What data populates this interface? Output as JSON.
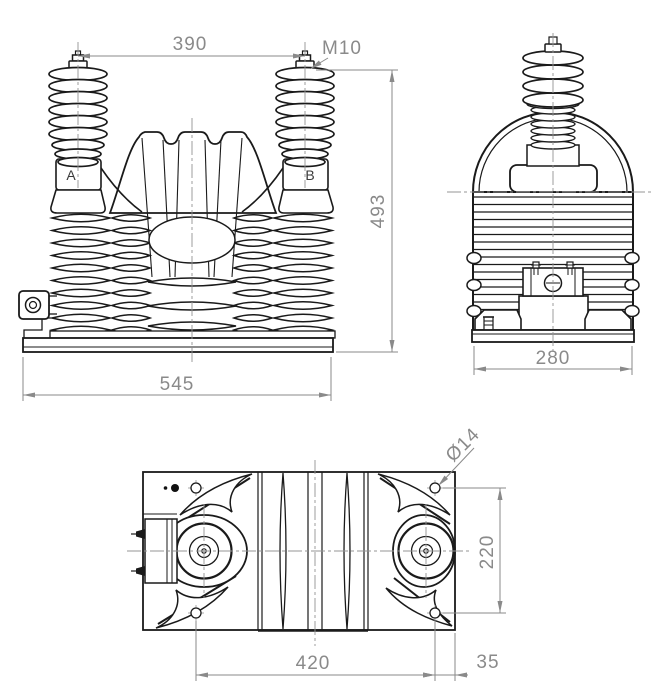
{
  "front_view": {
    "bushing_spacing": "390",
    "thread": "M10",
    "height": "493",
    "base_width": "545",
    "terminal_a": "A",
    "terminal_b": "B"
  },
  "side_view": {
    "depth": "280"
  },
  "top_view": {
    "hole_diameter": "Ø14",
    "hole_spacing_vertical": "220",
    "hole_spacing_horizontal": "420",
    "edge_offset": "35"
  },
  "colors": {
    "line": "#1a1a1a",
    "dimension": "#8a8a8a",
    "centerline": "#949494"
  }
}
